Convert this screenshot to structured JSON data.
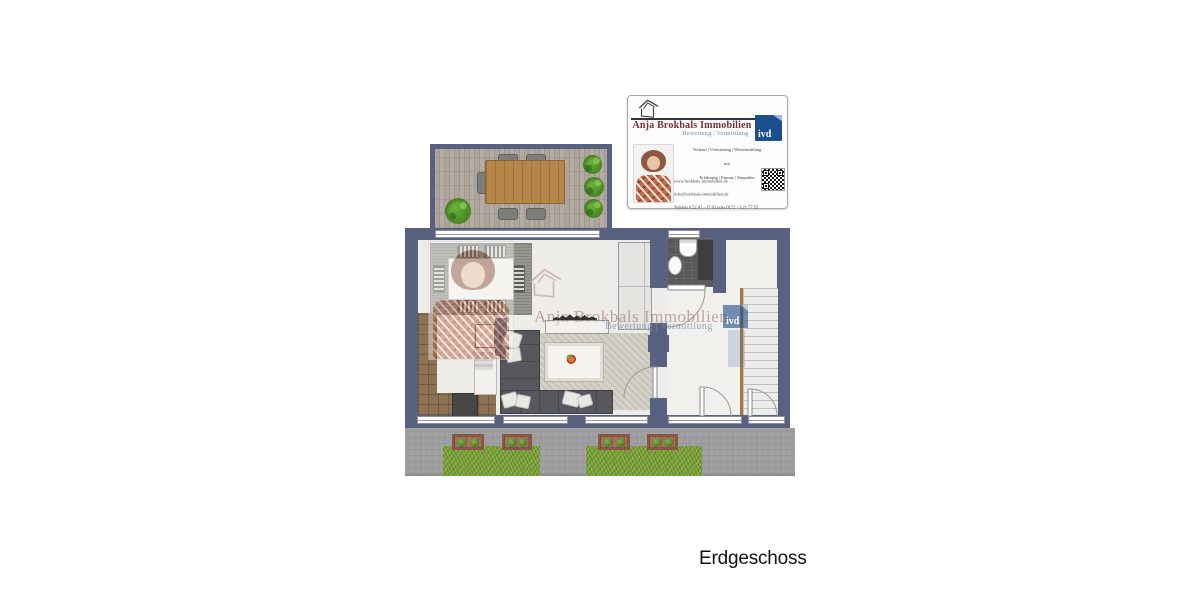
{
  "business_card": {
    "title": "Anja Brokbals Immobilien",
    "tagline": "Bewertung | Vermittlung",
    "ivd_label": "ivd",
    "services": {
      "line1": "Verkauf | Vermietung | Wertermittlung",
      "line2": "mit",
      "line3": "Erfahrung | Einsatz | Empathie"
    },
    "contact": {
      "website": "www.brokbals-immobilien.de",
      "email": "info@brokbals-immobilien.de",
      "phone": "Telefon 0 52 41 - 17 62 oder 0172 - 3 21 77 55"
    }
  },
  "watermark": {
    "title": "Anja Brokbals Immobilien",
    "tagline": "Bewertung | Vermittlung",
    "ivd_label": "ivd"
  },
  "caption": "Erdgeschoss",
  "icons": {
    "logo": "house-outline-icon",
    "qr": "qr-code-icon",
    "agent_photo": "agent-portrait",
    "plants": "bush-icon",
    "flower": "flower-icon"
  },
  "colors": {
    "wall": "#58617f",
    "floor": "#edece8",
    "accent_red": "#7d2c38",
    "accent_blue": "#6888ac",
    "ivd_blue": "#1c4e8c",
    "wood": "#b5854a",
    "counter": "#8d7354",
    "sofa": "#57575d",
    "grass": "#7ca23d",
    "pavement": "#9e9ea1"
  }
}
